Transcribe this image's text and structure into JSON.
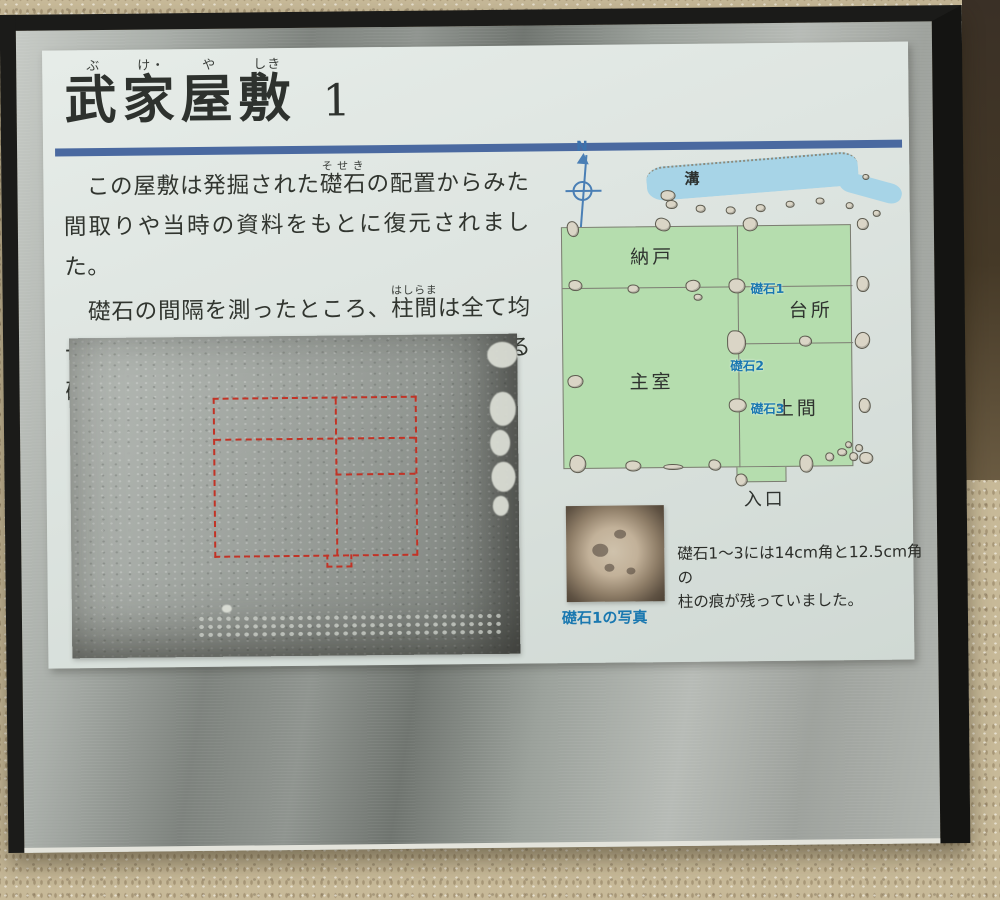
{
  "colors": {
    "rule_blue": "#4a69a0",
    "plan_green": "#b5ddae",
    "water_blue": "#a7d4e7",
    "stone_label_blue": "#1a78b0",
    "red_outline": "#c23326"
  },
  "sign": {
    "title": {
      "chars": [
        {
          "k": "武",
          "r": "ぶ"
        },
        {
          "k": "家",
          "r": "け・"
        },
        {
          "k": "屋",
          "r": "や"
        },
        {
          "k": "敷",
          "r": "しき"
        }
      ],
      "number": "1"
    },
    "paragraphs": [
      {
        "pre": "　この屋敷は発掘された",
        "ruby_base": "礎石",
        "ruby_text": "そせき",
        "post": "の配置からみた間取りや当時の資料をもとに復元されました。"
      },
      {
        "pre": "　礎石の間隔を測ったところ、",
        "ruby_base": "柱間",
        "ruby_text": "はしらま",
        "post": "は全て均一で1.97メートル（6尺5寸）を基本とする礎石建物であることがわかりました。"
      }
    ],
    "plan": {
      "north_label": "N",
      "ditch_label": "溝",
      "rooms": [
        {
          "label": "納戸"
        },
        {
          "label": "台所"
        },
        {
          "label": "主室"
        },
        {
          "label": "土間"
        }
      ],
      "entrance_label": "入口",
      "stones": [
        {
          "label": "礎石1"
        },
        {
          "label": "礎石2"
        },
        {
          "label": "礎石3"
        }
      ]
    },
    "stone_photo": {
      "caption": "礎石1の写真",
      "note_line1": "礎石1～3には14cm角と12.5cm角の",
      "note_line2": "柱の痕が残っていました。"
    }
  }
}
